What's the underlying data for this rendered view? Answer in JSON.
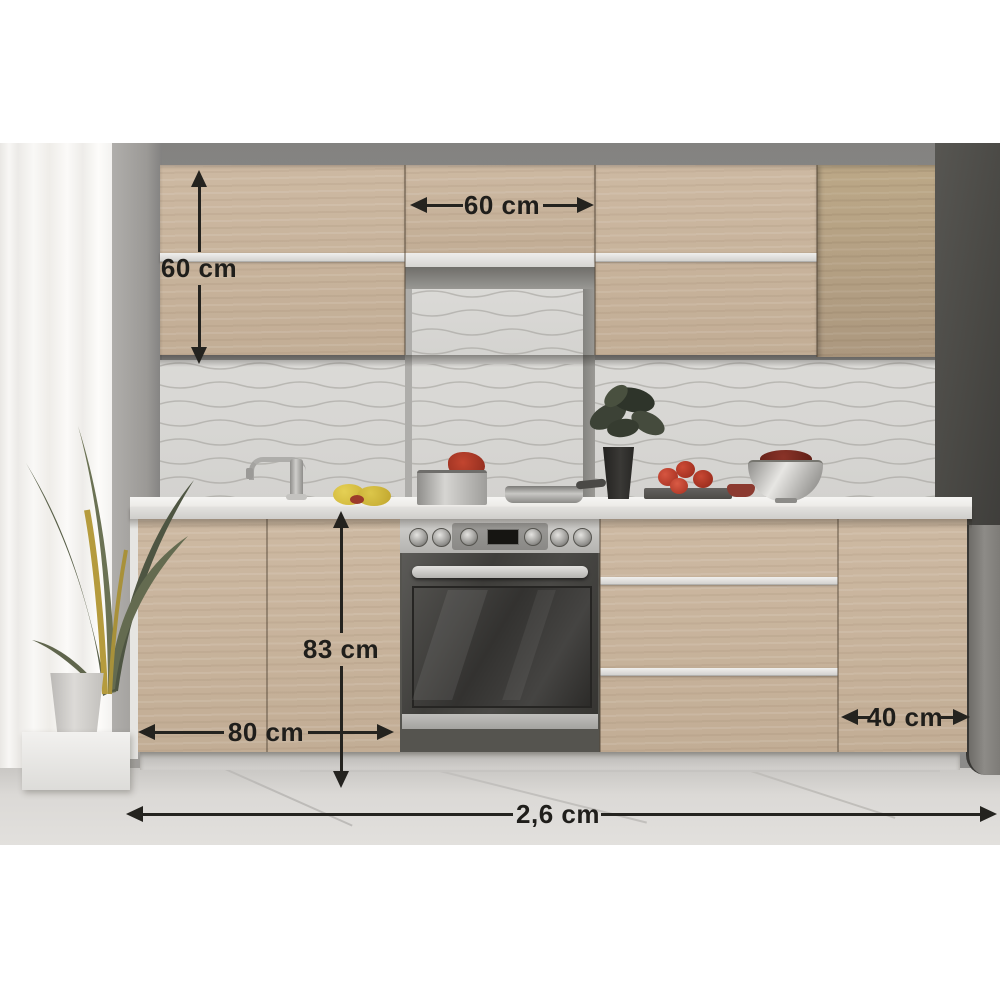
{
  "scene": {
    "description": "Kitchen cabinet set photo with overlaid dimension arrows",
    "objects": [
      "curtain",
      "floor-plant",
      "wall-cabinets",
      "cooker-hood-niche",
      "tile-backsplash",
      "countertop",
      "base-cabinets",
      "oven",
      "stockpot",
      "frying-pan",
      "faucet",
      "lemons",
      "vase-plant",
      "tomatoes",
      "fruit-bowl",
      "tall-dark-unit",
      "fridge",
      "tiled-floor"
    ]
  },
  "dims": [
    {
      "id": "wall-cabinet-height",
      "label": "60 cm",
      "orientation": "vertical"
    },
    {
      "id": "wall-cabinet-width",
      "label": "60 cm",
      "orientation": "horizontal"
    },
    {
      "id": "base-cabinet-height",
      "label": "83 cm",
      "orientation": "vertical"
    },
    {
      "id": "base-cabinet-width",
      "label": "80 cm",
      "orientation": "horizontal"
    },
    {
      "id": "right-base-cabinet-width",
      "label": "40 cm",
      "orientation": "horizontal"
    },
    {
      "id": "total-run-length",
      "label": "2,6 cm",
      "orientation": "horizontal"
    }
  ],
  "colors": {
    "wood": "#c6b199",
    "wood_dark": "#b3a088",
    "wall": "#8c8b89",
    "tiles": "#d7d6d3",
    "counter": "#f0efed",
    "dark_unit": "#4c4b47",
    "annotation": "#24231f",
    "floor": "#d9d7d4"
  }
}
